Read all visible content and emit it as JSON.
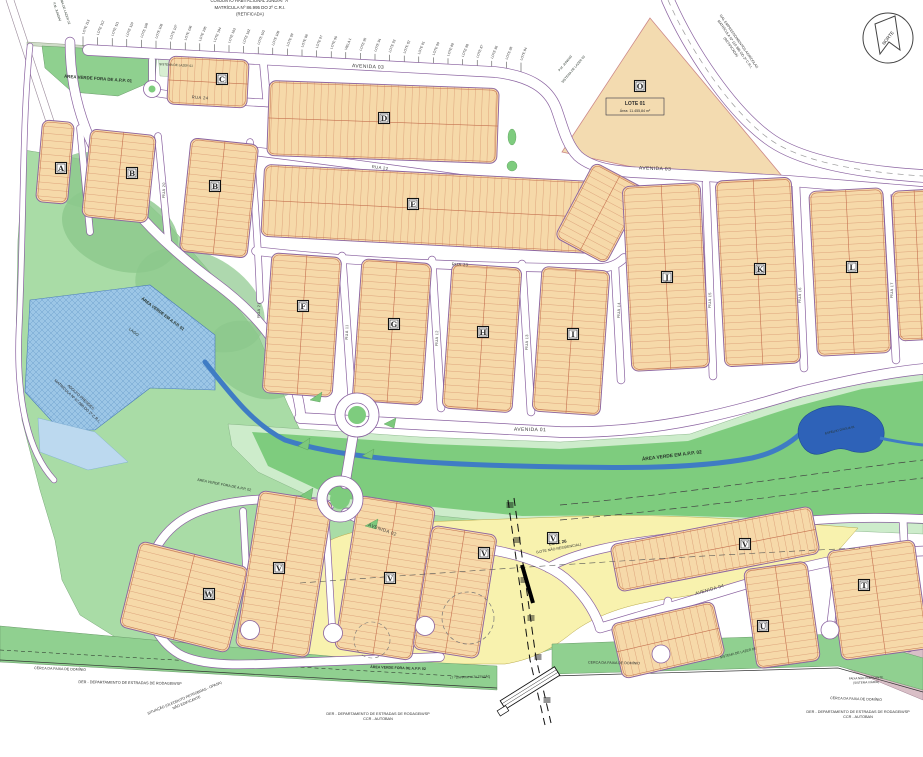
{
  "header": {
    "line1": "CONJUNTO HABITACIONAL JUNDIAÍ \"A\"",
    "line2": "MATRÍCULA Nº 86.995 DO 2º C.R.I.",
    "line3": "(RETIFICADA)"
  },
  "compass_label": "NORTE",
  "neighbor_lots": [
    "LOTE 113",
    "LOTE 112",
    "LOTE 111",
    "LOTE 110",
    "LOTE 109",
    "LOTE 108",
    "LOTE 107",
    "LOTE 106",
    "LOTE 105",
    "LOTE 104",
    "LOTE 103",
    "LOTE 102",
    "LOTE 101",
    "LOTE 100",
    "LOTE 99",
    "LOTE 98",
    "LOTE 97",
    "LOTE 96",
    "VIELA 1",
    "LOTE 95",
    "LOTE 94",
    "LOTE 93",
    "LOTE 92",
    "LOTE 91",
    "LOTE 90",
    "LOTE 89",
    "LOTE 88",
    "LOTE 87",
    "LOTE 86",
    "LOTE 85",
    "LOTE 84"
  ],
  "quadras": [
    {
      "letter": "A",
      "x": 61,
      "y": 168
    },
    {
      "letter": "B",
      "x": 132,
      "y": 173
    },
    {
      "letter": "B",
      "x": 215,
      "y": 186
    },
    {
      "letter": "C",
      "x": 222,
      "y": 79
    },
    {
      "letter": "D",
      "x": 384,
      "y": 118
    },
    {
      "letter": "E",
      "x": 413,
      "y": 204
    },
    {
      "letter": "F",
      "x": 303,
      "y": 306
    },
    {
      "letter": "G",
      "x": 394,
      "y": 324
    },
    {
      "letter": "H",
      "x": 483,
      "y": 332
    },
    {
      "letter": "I",
      "x": 573,
      "y": 334
    },
    {
      "letter": "J",
      "x": 667,
      "y": 277
    },
    {
      "letter": "K",
      "x": 760,
      "y": 269
    },
    {
      "letter": "L",
      "x": 852,
      "y": 267
    },
    {
      "letter": "O",
      "x": 640,
      "y": 86
    },
    {
      "letter": "W",
      "x": 209,
      "y": 594
    },
    {
      "letter": "V",
      "x": 279,
      "y": 568
    },
    {
      "letter": "V",
      "x": 390,
      "y": 578
    },
    {
      "letter": "V",
      "x": 484,
      "y": 553
    },
    {
      "letter": "V",
      "x": 553,
      "y": 538
    },
    {
      "letter": "V",
      "x": 745,
      "y": 544
    },
    {
      "letter": "U",
      "x": 763,
      "y": 626
    },
    {
      "letter": "T",
      "x": 864,
      "y": 585
    }
  ],
  "lote01": {
    "name": "LOTE 01",
    "area": "Área: 11.455,84 m²"
  },
  "lote26": {
    "name": "LOTE 26",
    "note": "(LOTE NÃO RESIDENCIAL)"
  },
  "streets": [
    {
      "name": "AVENIDA 03",
      "x": 368,
      "y": 68,
      "rot": 3,
      "size": 5
    },
    {
      "name": "AVENIDA 03",
      "x": 655,
      "y": 170,
      "rot": 2,
      "size": 5
    },
    {
      "name": "RUA 24",
      "x": 200,
      "y": 99,
      "rot": 4,
      "size": 4.2
    },
    {
      "name": "RUA 22",
      "x": 380,
      "y": 169,
      "rot": 7,
      "size": 4.2
    },
    {
      "name": "RUA 23",
      "x": 460,
      "y": 266,
      "rot": 3,
      "size": 4.2
    },
    {
      "name": "AVENIDA 01",
      "x": 530,
      "y": 431,
      "rot": 1,
      "size": 5
    },
    {
      "name": "AVENIDA 02",
      "x": 382,
      "y": 531,
      "rot": 20,
      "size": 4.6
    },
    {
      "name": "AVENIDA 04",
      "x": 710,
      "y": 591,
      "rot": -16,
      "size": 4.6
    },
    {
      "name": "RUA 20",
      "x": 165,
      "y": 190,
      "rot": -88,
      "size": 3.8
    },
    {
      "name": "RUA 21",
      "x": 260,
      "y": 310,
      "rot": -88,
      "size": 3.8
    },
    {
      "name": "RUA 11",
      "x": 348,
      "y": 332,
      "rot": -88,
      "size": 3.8
    },
    {
      "name": "RUA 12",
      "x": 438,
      "y": 338,
      "rot": -88,
      "size": 3.8
    },
    {
      "name": "RUA 13",
      "x": 528,
      "y": 342,
      "rot": -88,
      "size": 3.8
    },
    {
      "name": "RUA 14",
      "x": 620,
      "y": 310,
      "rot": -88,
      "size": 3.8
    },
    {
      "name": "RUA 15",
      "x": 711,
      "y": 300,
      "rot": -88,
      "size": 3.8
    },
    {
      "name": "RUA 16",
      "x": 801,
      "y": 295,
      "rot": -88,
      "size": 3.8
    },
    {
      "name": "RUA 17",
      "x": 893,
      "y": 290,
      "rot": -88,
      "size": 3.8
    }
  ],
  "areas": [
    {
      "name": "ÁREA VERDE FORA DE A.P.P. 01",
      "x": 98,
      "y": 80,
      "rot": 4,
      "size": 4.4,
      "bold": true,
      "color": "#27332a"
    },
    {
      "name": "SISTEMA DE LAZER 01",
      "x": 176,
      "y": 66,
      "rot": 3,
      "size": 3.1,
      "color": "#3c4a3e"
    },
    {
      "name": "P.M. JUNDIAÍ",
      "x": 56,
      "y": 12,
      "rot": 72,
      "size": 3.2,
      "color": "#3c4a3e"
    },
    {
      "name": "SISTEMA DE LAZER 02",
      "x": 63,
      "y": 8,
      "rot": 72,
      "size": 3.2,
      "color": "#3c4a3e"
    },
    {
      "name": "P.M. JUNDIAÍ",
      "x": 566,
      "y": 64,
      "rot": -50,
      "size": 3.2,
      "color": "#3c4a3e"
    },
    {
      "name": "SISTEMA DE LAZER 03",
      "x": 574,
      "y": 70,
      "rot": -50,
      "size": 3.2,
      "color": "#3c4a3e"
    },
    {
      "name": "ÁREA VERDE EM A.P.P. 01",
      "x": 162,
      "y": 315,
      "rot": 37,
      "size": 4.2,
      "bold": true,
      "color": "#27332a"
    },
    {
      "name": "LAGO",
      "x": 133,
      "y": 333,
      "rot": 37,
      "size": 4,
      "color": "#1d3a5f"
    },
    {
      "name": "ÁREA VERDE EM A.P.P. 02",
      "x": 672,
      "y": 457,
      "rot": -7,
      "size": 4.8,
      "bold": true,
      "color": "#27332a"
    },
    {
      "name": "ESPELHO D'ÁGUA 01",
      "x": 840,
      "y": 431,
      "rot": -13,
      "size": 3,
      "color": "#0f2f6f"
    },
    {
      "name": "ÁREA VERDE FORA DE A.P.P. 02",
      "x": 224,
      "y": 486,
      "rot": 11,
      "size": 3.6,
      "color": "#27332a"
    },
    {
      "name": "ÁREA VERDE FORA DE A.P.P. 02",
      "x": 398,
      "y": 669,
      "rot": 2,
      "size": 3.6,
      "bold": true,
      "color": "#27332a"
    },
    {
      "name": "SISTEMA DE LAZER 05",
      "x": 738,
      "y": 654,
      "rot": -14,
      "size": 3.4,
      "color": "#3c5a48"
    }
  ],
  "boundary_texts": [
    {
      "lines": [
        "CERCA DA FAIXA DE DOMÍNIO"
      ],
      "x": 60,
      "y": 670,
      "rot": 2,
      "size": 3.6,
      "color": "#333333"
    },
    {
      "lines": [
        "DER - DEPARTAMENTO DE ESTRADAS DE RODAGEM/SP"
      ],
      "x": 130,
      "y": 684,
      "rot": 1,
      "size": 3.8,
      "color": "#333333"
    },
    {
      "lines": [
        "SITUAÇÃO (OLEODUTO PETROBRAS - OPASA)",
        "NÃO EDIFICANTE"
      ],
      "x": 185,
      "y": 699,
      "rot": -23,
      "size": 3.6,
      "color": "#4a7ab8"
    },
    {
      "lines": [
        "DER - DEPARTAMENTO DE ESTRADAS DE RODAGEM/SP",
        "CCR - AUTOBAN"
      ],
      "x": 378,
      "y": 715,
      "rot": 0,
      "size": 3.8,
      "color": "#333333"
    },
    {
      "lines": [
        "CERCA DA FAIXA DE DOMÍNIO"
      ],
      "x": 614,
      "y": 664,
      "rot": 1,
      "size": 3.6,
      "color": "#333333"
    },
    {
      "lines": [
        "CERCA DA FAIXA DE DOMÍNIO"
      ],
      "x": 856,
      "y": 700,
      "rot": 2,
      "size": 3.6,
      "color": "#333333"
    },
    {
      "lines": [
        "DER - DEPARTAMENTO DE ESTRADAS DE RODAGEM/SP",
        "CCR - AUTOBAN"
      ],
      "x": 858,
      "y": 713,
      "rot": 0,
      "size": 3.8,
      "color": "#333333"
    },
    {
      "lines": [
        "FAIXA NÃO EDIFICANTE",
        "(SISTEMA VIÁRIO)"
      ],
      "x": 866,
      "y": 679,
      "rot": -2,
      "size": 3,
      "color": "#333333"
    },
    {
      "lines": [
        "LT - LINHA DE ALTA TENSÃO"
      ],
      "x": 470,
      "y": 678,
      "rot": -2,
      "size": 3,
      "color": "#333333"
    },
    {
      "lines": [
        "GAL EMPREENDIMENTOS AGRÍCOLAS",
        "MATRÍCULA Nº 110.386 DO 2º C.R.I.",
        "(RETIFICADA)"
      ],
      "x": 738,
      "y": 42,
      "rot": 55,
      "size": 3.5,
      "color": "#333333"
    },
    {
      "lines": [
        "ADOLFO PRENDES",
        "MATRÍCULA Nº 67.088 DO 2º C.R.I."
      ],
      "x": 80,
      "y": 398,
      "rot": 43,
      "size": 3.8,
      "color": "#333333"
    }
  ],
  "colors": {
    "water": "#9cc6e6",
    "water_pale": "#bcd9ef",
    "stream": "#3f7cc4",
    "pond": "#2e62b8",
    "green_dark": "#7ecc7e",
    "green": "#a9dca6",
    "green_mint": "#cdeccb",
    "green_band": "#90d090",
    "lot_fill": "#f6d9a9",
    "lot_line": "#c4704f",
    "road_edge": "#8a62a0",
    "yellow": "#f8f2ae",
    "pink": "#d9bfc7",
    "sand": "#f3dbb0"
  }
}
